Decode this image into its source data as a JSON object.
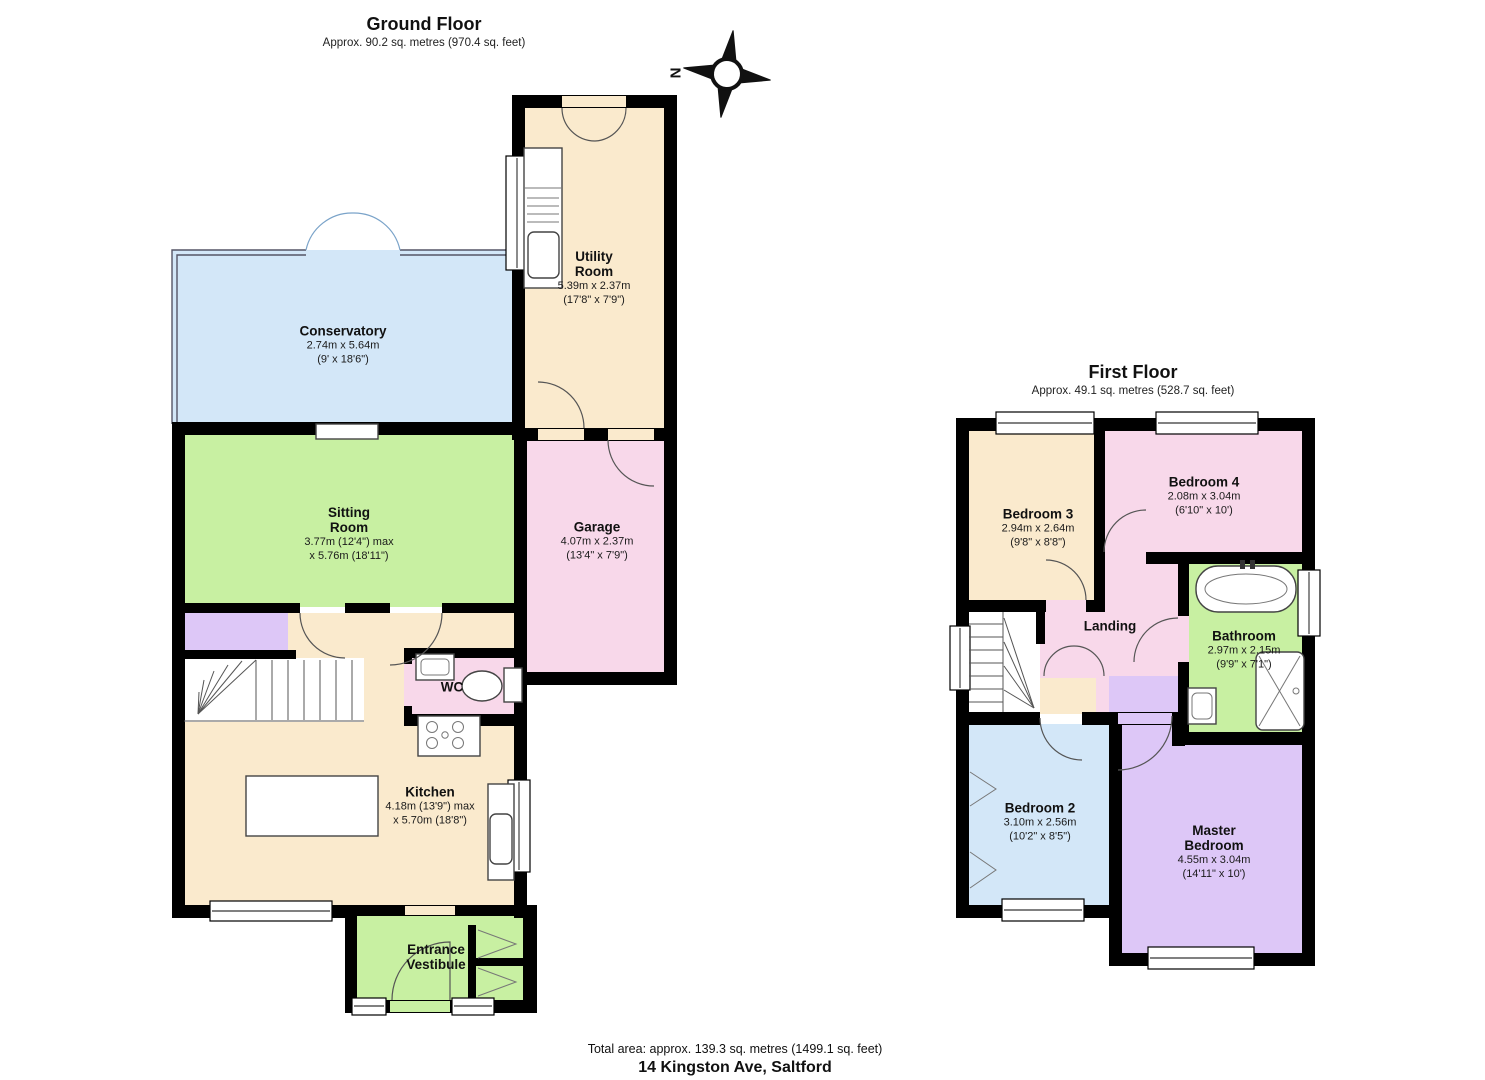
{
  "floors": [
    {
      "name": "Ground Floor",
      "area": "Approx. 90.2 sq. metres (970.4 sq. feet)",
      "rooms": [
        {
          "name": "Conservatory",
          "dims": "2.74m x 5.64m\n(9' x 18'6\")"
        },
        {
          "name": "Utility Room",
          "dims": "5.39m x 2.37m\n(17'8\" x 7'9\")"
        },
        {
          "name": "Sitting Room",
          "dims": "3.77m (12'4\") max\nx 5.76m (18'11\")"
        },
        {
          "name": "Garage",
          "dims": "4.07m x 2.37m\n(13'4\" x 7'9\")"
        },
        {
          "name": "WC",
          "dims": ""
        },
        {
          "name": "Kitchen",
          "dims": "4.18m (13'9\") max\nx 5.70m (18'8\")"
        },
        {
          "name": "Entrance Vestibule",
          "dims": ""
        }
      ]
    },
    {
      "name": "First Floor",
      "area": "Approx. 49.1 sq. metres (528.7 sq. feet)",
      "rooms": [
        {
          "name": "Bedroom 3",
          "dims": "2.94m x 2.64m\n(9'8\" x 8'8\")"
        },
        {
          "name": "Bedroom 4",
          "dims": "2.08m x 3.04m\n(6'10\" x 10')"
        },
        {
          "name": "Landing",
          "dims": ""
        },
        {
          "name": "Bathroom",
          "dims": "2.97m x 2.15m\n(9'9\" x 7'1\")"
        },
        {
          "name": "Bedroom 2",
          "dims": "3.10m x 2.56m\n(10'2\" x 8'5\")"
        },
        {
          "name": "Master Bedroom",
          "dims": "4.55m x 3.04m\n(14'11\" x 10')"
        }
      ]
    }
  ],
  "compass": {
    "north_label": "N"
  },
  "footer": {
    "total_area": "Total area: approx. 139.3 sq. metres (1499.1 sq. feet)",
    "address": "14 Kingston Ave, Saltford"
  },
  "colors": {
    "cream": "#faeacd",
    "green": "#c8f0a2",
    "pink": "#f8d8ea",
    "blue": "#d3e7f8",
    "purple": "#ddc7f7",
    "wall": "#000000"
  }
}
